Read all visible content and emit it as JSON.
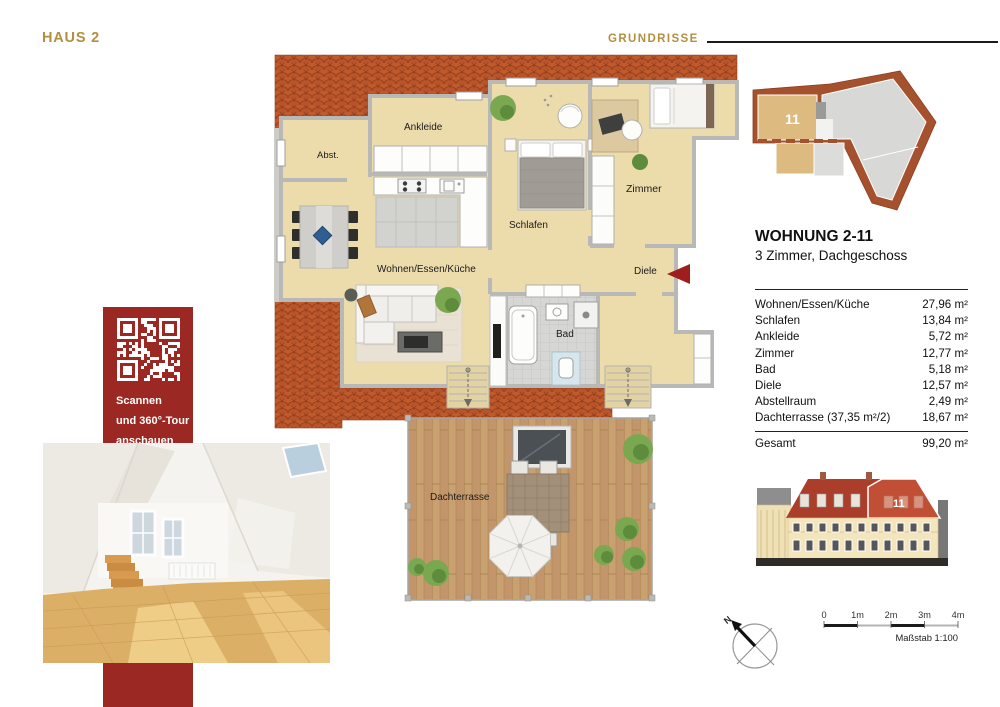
{
  "header": {
    "house": "HAUS 2",
    "section": "GRUNDRISSE"
  },
  "apartment": {
    "title": "WOHNUNG 2-11",
    "subtitle": "3 Zimmer, Dachgeschoss",
    "unit_badge": "11"
  },
  "area_table": {
    "rows": [
      {
        "label": "Wohnen/Essen/Küche",
        "value": "27,96 m²"
      },
      {
        "label": "Schlafen",
        "value": "13,84 m²"
      },
      {
        "label": "Ankleide",
        "value": "5,72 m²"
      },
      {
        "label": "Zimmer",
        "value": "12,77 m²"
      },
      {
        "label": "Bad",
        "value": "5,18 m²"
      },
      {
        "label": "Diele",
        "value": "12,57 m²"
      },
      {
        "label": "Abstellraum",
        "value": "2,49 m²"
      },
      {
        "label": "Dachterrasse (37,35 m²/2)",
        "value": "18,67 m²"
      }
    ],
    "total": {
      "label": "Gesamt",
      "value": "99,20 m²"
    }
  },
  "floorplan": {
    "rooms": {
      "abst": "Abst.",
      "ankleide": "Ankleide",
      "schlafen": "Schlafen",
      "zimmer": "Zimmer",
      "wohnen": "Wohnen/Essen/Küche",
      "diele": "Diele",
      "bad": "Bad",
      "dachterrasse": "Dachterrasse"
    }
  },
  "qr_panel": {
    "lines": [
      "Scannen",
      "und 360°-Tour",
      "anschauen"
    ]
  },
  "scale_bar": {
    "ticks": [
      "0",
      "1m",
      "2m",
      "3m",
      "4m"
    ],
    "caption": "Maßstab 1:100"
  },
  "compass": {
    "north": "N"
  },
  "colors": {
    "accent_gold": "#b2903e",
    "brand_red": "#9b2823",
    "roof_tile": "#c05a2b",
    "floor_cream": "#ecdbab",
    "terrace_wood": "#c9a06f",
    "elevation_highlight": "#c04f35"
  }
}
